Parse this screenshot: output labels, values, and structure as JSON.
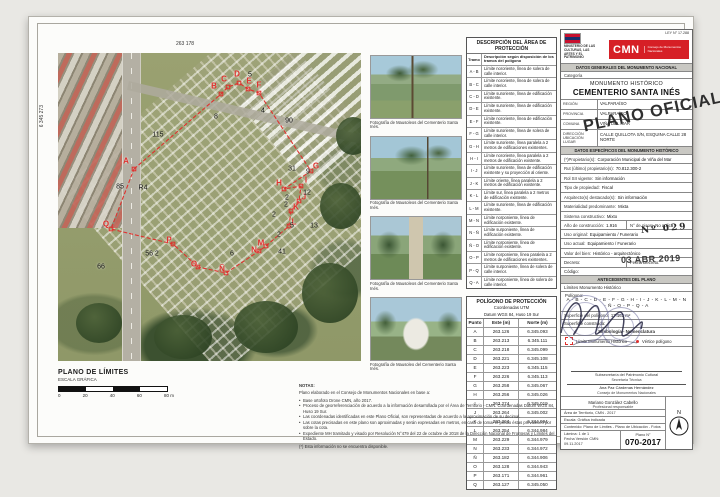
{
  "colors": {
    "cmn_red": "#d61f26",
    "polygon_red": "#e0312e"
  },
  "map": {
    "coord_top": "263 178",
    "coord_left": "6 345 273",
    "plan_title": "PLANO DE LÍMITES",
    "plan_subtitle": "ESCALA GRÁFICA",
    "scale_ticks": [
      "0",
      "20",
      "40",
      "60",
      "80 m"
    ],
    "polygon_points": [
      [
        76,
        116
      ],
      [
        163,
        41
      ],
      [
        170,
        34
      ],
      [
        181,
        30
      ],
      [
        190,
        36
      ],
      [
        201,
        40
      ],
      [
        253,
        118
      ],
      [
        226,
        136
      ],
      [
        243,
        133
      ],
      [
        241,
        148
      ],
      [
        233,
        158
      ],
      [
        231,
        173
      ],
      [
        208,
        193
      ],
      [
        201,
        198
      ],
      [
        168,
        220
      ],
      [
        140,
        214
      ],
      [
        115,
        191
      ],
      [
        53,
        176
      ]
    ],
    "vertices": [
      {
        "t": "A",
        "x": 68,
        "y": 108
      },
      {
        "t": "B",
        "x": 156,
        "y": 33
      },
      {
        "t": "C",
        "x": 166,
        "y": 26
      },
      {
        "t": "D",
        "x": 179,
        "y": 21
      },
      {
        "t": "E",
        "x": 191,
        "y": 28
      },
      {
        "t": "F",
        "x": 201,
        "y": 32
      },
      {
        "t": "G",
        "x": 258,
        "y": 113
      },
      {
        "t": "H",
        "x": 221,
        "y": 130
      },
      {
        "t": "I",
        "x": 248,
        "y": 127
      },
      {
        "t": "J",
        "x": 246,
        "y": 144
      },
      {
        "t": "K",
        "x": 238,
        "y": 154
      },
      {
        "t": "L",
        "x": 236,
        "y": 169
      },
      {
        "t": "M",
        "x": 203,
        "y": 190
      },
      {
        "t": "N",
        "x": 196,
        "y": 197
      },
      {
        "t": "Ñ",
        "x": 164,
        "y": 216
      },
      {
        "t": "O",
        "x": 136,
        "y": 211
      },
      {
        "t": "P",
        "x": 111,
        "y": 187
      },
      {
        "t": "Q",
        "x": 48,
        "y": 171
      }
    ],
    "dims": [
      {
        "t": "115",
        "x": 100,
        "y": 82
      },
      {
        "t": "8",
        "x": 158,
        "y": 64
      },
      {
        "t": "5",
        "x": 192,
        "y": 22
      },
      {
        "t": "4",
        "x": 205,
        "y": 58
      },
      {
        "t": "90",
        "x": 231,
        "y": 68
      },
      {
        "t": "31",
        "x": 234,
        "y": 116
      },
      {
        "t": "9",
        "x": 250,
        "y": 119
      },
      {
        "t": "12",
        "x": 249,
        "y": 140
      },
      {
        "t": "2",
        "x": 229,
        "y": 145
      },
      {
        "t": "2",
        "x": 228,
        "y": 152
      },
      {
        "t": "2",
        "x": 216,
        "y": 162
      },
      {
        "t": "5",
        "x": 234,
        "y": 173
      },
      {
        "t": "13",
        "x": 256,
        "y": 173
      },
      {
        "t": "2",
        "x": 221,
        "y": 182
      },
      {
        "t": "41",
        "x": 224,
        "y": 199
      },
      {
        "t": "6",
        "x": 174,
        "y": 201
      },
      {
        "t": "56 2",
        "x": 94,
        "y": 201
      },
      {
        "t": "85",
        "x": 62,
        "y": 134
      },
      {
        "t": "R4",
        "x": 85,
        "y": 135
      },
      {
        "t": "66",
        "x": 43,
        "y": 214
      }
    ]
  },
  "photos": [
    {
      "caption": "Fotografía de Mausoleos del Cementerio Santa Inés."
    },
    {
      "caption": "Fotografía de Mausoleos del Cementerio Santa Inés."
    },
    {
      "caption": "Fotografía de Mausoleos del Cementerio Santa Inés."
    },
    {
      "caption": "Fotografía de Mausoleo del Cementerio Santa Inés."
    }
  ],
  "area_table": {
    "title": "DESCRIPCIÓN DEL ÁREA DE PROTECCIÓN",
    "col1": "Tramo",
    "col2": "Descripción según disposición de los tramos del polígono",
    "rows": [
      {
        "t": "A - B",
        "d": "Límite nororiente, línea de solera de calle interior."
      },
      {
        "t": "B - C",
        "d": "Límite nororiente, línea de solera de calle interior."
      },
      {
        "t": "C - D",
        "d": "Límite suroriente, línea de edificación existente."
      },
      {
        "t": "D - E",
        "d": "Límite suroriente, línea de edificación existente."
      },
      {
        "t": "E - F",
        "d": "Límite nororiente, línea de edificación existente."
      },
      {
        "t": "F - G",
        "d": "Límite suroriente, línea de solera de calle interior."
      },
      {
        "t": "G - H",
        "d": "Límite suroriente, línea paralela a 2 metros de edificaciones existentes."
      },
      {
        "t": "H - I",
        "d": "Límite nororiente, línea paralela a 2 metros de edificación existente."
      },
      {
        "t": "I - J",
        "d": "Límite suroriente, línea de edificación existente y su proyección al oriente."
      },
      {
        "t": "J - K",
        "d": "Límite oriente, línea paralela a 2 metros de edificación existente."
      },
      {
        "t": "K - L",
        "d": "Límite sur, línea paralela a 2 metros de edificación existente."
      },
      {
        "t": "L - M",
        "d": "Límite suroriente, línea de edificación existente."
      },
      {
        "t": "M - N",
        "d": "Límite norponiente, línea de edificación existente."
      },
      {
        "t": "N - Ñ",
        "d": "Límite surponiente, línea de edificación existente."
      },
      {
        "t": "Ñ - O",
        "d": "Límite norponiente, línea de edificación existente."
      },
      {
        "t": "O - P",
        "d": "Límite norponiente, línea paralela a 2 metros de edificaciones existentes."
      },
      {
        "t": "P - Q",
        "d": "Límite surponiente, línea de solera de calle interior."
      },
      {
        "t": "Q - A",
        "d": "Límite norponiente, línea de solera de calle interior."
      }
    ]
  },
  "polygon_table": {
    "title": "POLÍGONO DE PROTECCIÓN",
    "sub1": "Coordenadas UTM",
    "sub2": "Datum WGS 84, Huso 19 Sur",
    "col1": "Punto",
    "col2": "Este (m)",
    "col3": "Norte (m)",
    "rows": [
      {
        "p": "A",
        "e": "263.126",
        "n": "6.345.093"
      },
      {
        "p": "B",
        "e": "263.213",
        "n": "6.345.111"
      },
      {
        "p": "C",
        "e": "263.218",
        "n": "6.345.099"
      },
      {
        "p": "D",
        "e": "263.221",
        "n": "6.345.108"
      },
      {
        "p": "E",
        "e": "263.223",
        "n": "6.345.115"
      },
      {
        "p": "F",
        "e": "263.226",
        "n": "6.345.113"
      },
      {
        "p": "G",
        "e": "263.258",
        "n": "6.345.067"
      },
      {
        "p": "H",
        "e": "263.256",
        "n": "6.345.026"
      },
      {
        "p": "I",
        "e": "263.274",
        "n": "6.345.019"
      },
      {
        "p": "J",
        "e": "263.264",
        "n": "6.345.002"
      },
      {
        "p": "K",
        "e": "263.264",
        "n": "6.344.994"
      },
      {
        "p": "L",
        "e": "263.254",
        "n": "6.344.984"
      },
      {
        "p": "M",
        "e": "263.229",
        "n": "6.344.979"
      },
      {
        "p": "N",
        "e": "263.233",
        "n": "6.344.972"
      },
      {
        "p": "Ñ",
        "e": "263.182",
        "n": "6.344.906"
      },
      {
        "p": "O",
        "e": "263.128",
        "n": "6.344.943"
      },
      {
        "p": "P",
        "e": "263.171",
        "n": "6.344.961"
      },
      {
        "p": "Q",
        "e": "263.127",
        "n": "6.345.050"
      }
    ]
  },
  "notes": {
    "title": "NOTAS:",
    "intro": "Plano elaborado en el Consejo de Monumentos Nacionales en base a:",
    "bullets": [
      "Base ortofoto Drone CMN, año 2017.",
      "Proceso de georreferenciación de acuerdo a la información desarrollada por el Área de Territorio - CMN. Coordenadas Datum WGS 84, Huso 19 Sur.",
      "Las coordenadas identificadas en este Plano Oficial, son representadas de acuerdo a la aproximación de su decimal.",
      "Las cotas precisadas en este plano son aproximadas y serán expresadas en metros, en caso de tomar el predio éstas prevalecen por sobre la cota.",
      "Expediente MH tramitado y visado por Resolución N°479 del 22 de octubre de 2018 de la Dirección Nacional de Fronteras y Límites del Estado."
    ],
    "final": "(*) Esta información no se encuentra disponible."
  },
  "titleblock": {
    "ley": "LEY N° 17.288",
    "ministry": "MINISTERIO DE LAS CULTURAS, LAS ARTES Y EL PATRIMONIO",
    "cmn": "CMN",
    "cmn_small": "Consejo de Monumentos Nacionales",
    "bar_generales": "DATOS GENERALES DEL MONUMENTO NACIONAL",
    "categoria_label": "Categoría",
    "categoria": "MONUMENTO HISTÓRICO",
    "nombre": "CEMENTERIO SANTA INÉS",
    "geo": [
      {
        "label": "REGIÓN",
        "value": "VALPARAÍSO"
      },
      {
        "label": "PROVINCIA",
        "value": "VALPARAÍSO"
      },
      {
        "label": "COMUNA",
        "value": "VIÑA DEL MAR"
      },
      {
        "label": "DIRECCIÓN UBICACIÓN LUGAR",
        "value": "CALLE QUILLOTA S/N, ESQUINA CALLE 28 NORTE"
      }
    ],
    "bar_especificos": "DATOS ESPECÍFICOS DEL MONUMENTO HISTÓRICO",
    "specs1": [
      {
        "label": "(*)Propietario(s):",
        "value": "Corporación Municipal de Viña del Mar"
      },
      {
        "label": "Rut (último) propietario(s):",
        "value": "70.812.300-2"
      },
      {
        "label": "Rol SII vigente:",
        "value": "Sin información"
      },
      {
        "label": "Tipo de propiedad:",
        "value": "Fiscal"
      },
      {
        "label": "Arquitecto(s) destacado(s):",
        "value": "Sin información"
      },
      {
        "label": "Materialidad predominante:",
        "value": "Mixta"
      },
      {
        "label": "Sistema constructivo:",
        "value": "Mixto"
      }
    ],
    "anio_label": "Año de construcción:",
    "anio_value": "1.916",
    "pisos_label": "N° de pisos:",
    "pisos_value": "No aplica",
    "specs2": [
      {
        "label": "Uso original:",
        "value": "Equipamiento / Funerario"
      },
      {
        "label": "Uso actual:",
        "value": "Equipamiento / Funerario"
      },
      {
        "label": "Valor del bien:",
        "value": "Histórico - arquitectónico"
      }
    ],
    "decreto_label": "Decreto:",
    "fecha_decreto_label": "Fecha Decreto:",
    "codigo_label": "Código:",
    "bar_antecedentes": "ANTECEDENTES DEL PLANO",
    "limites": "Límites Monumento Histórico",
    "poligono_label": "Polígono:",
    "poligono_letters": "A - B - C - D - E - F - G - H - I - J - K - L - M - N - Ñ - O - P - Q - A",
    "sup_poligono_label": "Superficie del polígono:",
    "sup_poligono_value": "17.161 m²",
    "sup_construida_label": "Superficie construida:",
    "simbologia": "Simbología - Nomenclatura",
    "legend": [
      {
        "label": "Límite Monumento Histórico"
      },
      {
        "label": "Vértice polígono"
      }
    ],
    "firma1_cargo": "Subsecretaría del Patrimonio Cultural",
    "firma1_sub": "Secretaría Técnica",
    "firma2_nombre": "Ana Paz Cárdenas Hernández",
    "firma2_cargo": "Consejo de Monumentos Nacionales",
    "prof_nombre": "Mariano González Cabello",
    "prof_cargo": "Profesional responsable",
    "area_line": "Área de Territorio, CMN - 2017",
    "escala_line": "Escala: Gráfica indicada",
    "contenido_line": "Contenido: Plano de Límites - Plano de Ubicación - Fotos",
    "lamina_line": "Lámina: 1 de 1",
    "fecha_line": "Fecha Versión CMN: 09.11.2017",
    "plano_n_label": "Plano N°",
    "plano_n_value": "070-2017",
    "north_label": "N"
  },
  "stamps": {
    "oficial": "PLANO OFICIAL",
    "numero": "Nº 029",
    "fecha": "03 ABR 2019"
  }
}
